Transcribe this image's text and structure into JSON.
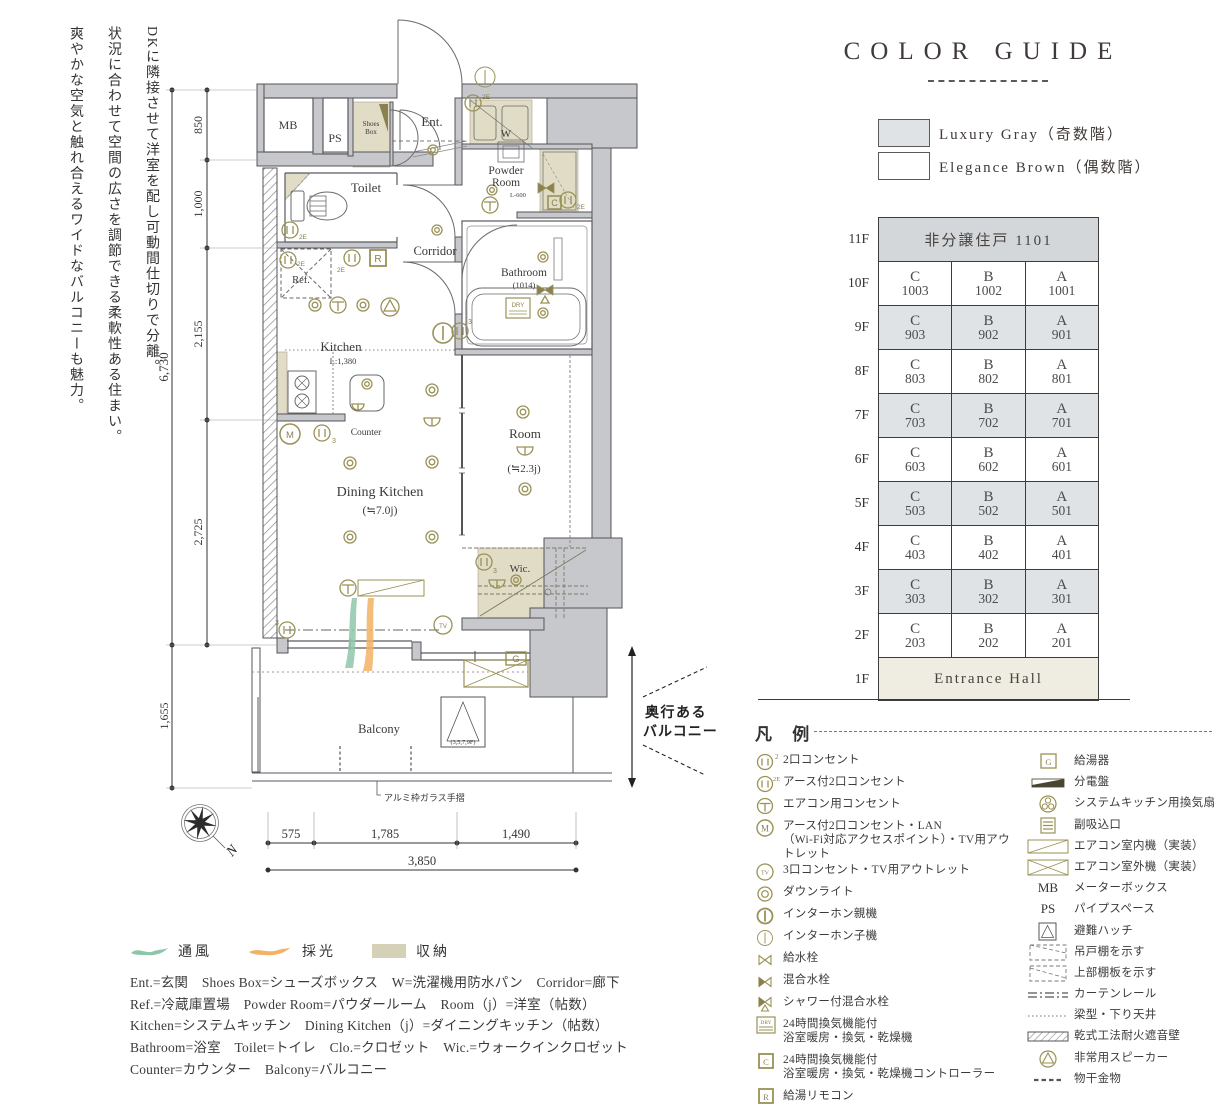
{
  "intro": {
    "lines": [
      "DKに隣接させて洋室を配し可動間仕切りで分離。",
      "状況に合わせて空間の広さを調節できる柔軟性ある住まい。",
      "爽やかな空気と触れ合えるワイドなバルコニーも魅力。"
    ]
  },
  "colors": {
    "accent_olive": "#9a9156",
    "wall_gray": "#c7c8cb",
    "row_gray": "#dfe3e6",
    "row_dark": "#d4d7d9",
    "entrance_beige": "#efede2",
    "storage_beige": "#e0dcc6"
  },
  "color_guide": {
    "title": "COLOR GUIDE",
    "swatches": [
      {
        "label": "Luxury Gray（奇数階）",
        "color": "#dfe3e6"
      },
      {
        "label": "Elegance Brown（偶数階）",
        "color": "#ffffff"
      }
    ]
  },
  "floor_table": {
    "rows": [
      {
        "floor": "11F",
        "span": "非分譲住戸 1101"
      },
      {
        "floor": "10F",
        "units": [
          [
            "C",
            "1003"
          ],
          [
            "B",
            "1002"
          ],
          [
            "A",
            "1001"
          ]
        ]
      },
      {
        "floor": "9F",
        "units": [
          [
            "C",
            "903"
          ],
          [
            "B",
            "902"
          ],
          [
            "A",
            "901"
          ]
        ]
      },
      {
        "floor": "8F",
        "units": [
          [
            "C",
            "803"
          ],
          [
            "B",
            "802"
          ],
          [
            "A",
            "801"
          ]
        ]
      },
      {
        "floor": "7F",
        "units": [
          [
            "C",
            "703"
          ],
          [
            "B",
            "702"
          ],
          [
            "A",
            "701"
          ]
        ]
      },
      {
        "floor": "6F",
        "units": [
          [
            "C",
            "603"
          ],
          [
            "B",
            "602"
          ],
          [
            "A",
            "601"
          ]
        ]
      },
      {
        "floor": "5F",
        "units": [
          [
            "C",
            "503"
          ],
          [
            "B",
            "502"
          ],
          [
            "A",
            "501"
          ]
        ]
      },
      {
        "floor": "4F",
        "units": [
          [
            "C",
            "403"
          ],
          [
            "B",
            "402"
          ],
          [
            "A",
            "401"
          ]
        ]
      },
      {
        "floor": "3F",
        "units": [
          [
            "C",
            "303"
          ],
          [
            "B",
            "302"
          ],
          [
            "A",
            "301"
          ]
        ]
      },
      {
        "floor": "2F",
        "units": [
          [
            "C",
            "203"
          ],
          [
            "B",
            "202"
          ],
          [
            "A",
            "201"
          ]
        ]
      },
      {
        "floor": "1F",
        "span": "Entrance Hall"
      }
    ]
  },
  "plan": {
    "rooms": {
      "mb": "MB",
      "ps": "PS",
      "shoes1": "Shoes",
      "shoes2": "Box",
      "ent": "Ent.",
      "w": "W",
      "powder1": "Powder",
      "powder2": "Room",
      "l600": "L-600",
      "toilet": "Toilet",
      "corridor": "Corridor",
      "bath": "Bathroom",
      "bath_size": "(1014)",
      "ref": "Ref.",
      "kitchen": "Kitchen",
      "kitchen_l": "L:1,380",
      "counter": "Counter",
      "dk": "Dining Kitchen",
      "dk_size": "(≒7.0j)",
      "room": "Room",
      "room_size": "(≒2.3j)",
      "wic": "Wic.",
      "balcony": "Balcony",
      "hatch_floors": "(3,5,7,9F)"
    },
    "dims": {
      "total_v": "6,730",
      "v_850": "850",
      "v_1000": "1,000",
      "v_2155": "2,155",
      "v_2725": "2,725",
      "v_1655": "1,655",
      "h_575": "575",
      "h_1785": "1,785",
      "h_1490": "1,490",
      "total_h": "3,850"
    },
    "notes": {
      "balcony_depth1": "奥行ある",
      "balcony_depth2": "バルコニー",
      "handrail": "アルミ枠ガラス手摺",
      "north": "N"
    },
    "symbols": {
      "g": "G",
      "r": "R",
      "c": "C",
      "dry": "DRY",
      "tv": "TV",
      "m": "M",
      "n2e": "2E",
      "n3": "3",
      "n2": "2"
    }
  },
  "legend": {
    "title": "凡 例",
    "left": [
      {
        "sup": "2",
        "label": "2口コンセント"
      },
      {
        "sup": "2E",
        "label": "アース付2口コンセント"
      },
      {
        "label": "エアコン用コンセント"
      },
      {
        "label": "アース付2口コンセント・LAN",
        "label2": "（Wi-Fi対応アクセスポイント）・TV用アウトレット"
      },
      {
        "label": "3口コンセント・TV用アウトレット"
      },
      {
        "label": "ダウンライト"
      },
      {
        "label": "インターホン親機"
      },
      {
        "label": "インターホン子機"
      },
      {
        "label": "給水栓"
      },
      {
        "label": "混合水栓"
      },
      {
        "label": "シャワー付混合水栓"
      },
      {
        "label": "24時間換気機能付",
        "label2": "浴室暖房・換気・乾燥機"
      },
      {
        "label": "24時間換気機能付",
        "label2": "浴室暖房・換気・乾燥機コントローラー"
      },
      {
        "label": "給湯リモコン"
      }
    ],
    "right": [
      {
        "label": "給湯器"
      },
      {
        "label": "分電盤"
      },
      {
        "label": "システムキッチン用換気扇"
      },
      {
        "label": "副吸込口"
      },
      {
        "label": "エアコン室内機（実装）"
      },
      {
        "label": "エアコン室外機（実装）"
      },
      {
        "symbol": "MB",
        "label": "メーターボックス"
      },
      {
        "symbol": "PS",
        "label": "パイプスペース"
      },
      {
        "label": "避難ハッチ"
      },
      {
        "label": "吊戸棚を示す"
      },
      {
        "label": "上部棚板を示す"
      },
      {
        "label": "カーテンレール"
      },
      {
        "label": "梁型・下り天井"
      },
      {
        "label": "乾式工法耐火遮音壁"
      },
      {
        "label": "非常用スピーカー"
      },
      {
        "label": "物干金物"
      }
    ]
  },
  "flow_legend": {
    "airflow": "通風",
    "daylight": "採光",
    "storage": "収納"
  },
  "abbreviations": [
    "Ent.=玄関　Shoes Box=シューズボックス　W=洗濯機用防水パン　Corridor=廊下",
    "Ref.=冷蔵庫置場　Powder Room=パウダールーム　Room（j）=洋室（帖数）",
    "Kitchen=システムキッチン　Dining Kitchen（j）=ダイニングキッチン（帖数）",
    "Bathroom=浴室　Toilet=トイレ　Clo.=クロゼット　Wic.=ウォークインクロゼット",
    "Counter=カウンター　Balcony=バルコニー"
  ]
}
